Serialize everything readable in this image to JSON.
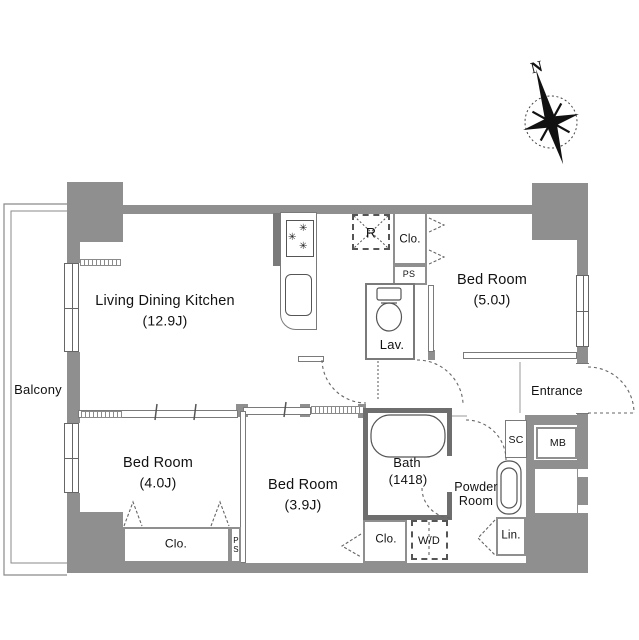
{
  "plan": {
    "compass": {
      "north": "N"
    },
    "balcony": {
      "label": "Balcony"
    },
    "rooms": {
      "ldk": {
        "name": "Living Dining Kitchen",
        "size": "(12.9J)"
      },
      "bedroom_5": {
        "name": "Bed Room",
        "size": "(5.0J)"
      },
      "bedroom_4": {
        "name": "Bed Room",
        "size": "(4.0J)"
      },
      "bedroom_3_9": {
        "name": "Bed Room",
        "size": "(3.9J)"
      },
      "bath": {
        "name": "Bath",
        "size": "(1418)"
      },
      "lavatory": {
        "label": "Lav."
      },
      "powder_room": {
        "label_line1": "Powder",
        "label_line2": "Room"
      },
      "entrance": {
        "label": "Entrance"
      }
    },
    "fixtures": {
      "refrigerator": "R",
      "closet_bedroom5": "Clo.",
      "closet_bedroom4": "Clo.",
      "closet_bedroom39": "Clo.",
      "pipe_space_top": "PS",
      "pipe_space_bottom": "PS",
      "shoe_closet": "SC",
      "meter_box": "MB",
      "washer_dryer": "W/D",
      "linen_closet": "Lin."
    },
    "icons": {
      "stove_burner": "✳"
    },
    "colors": {
      "wall": "#8f8f8f",
      "wall_dark": "#6e6e6e",
      "line": "#555555"
    }
  }
}
